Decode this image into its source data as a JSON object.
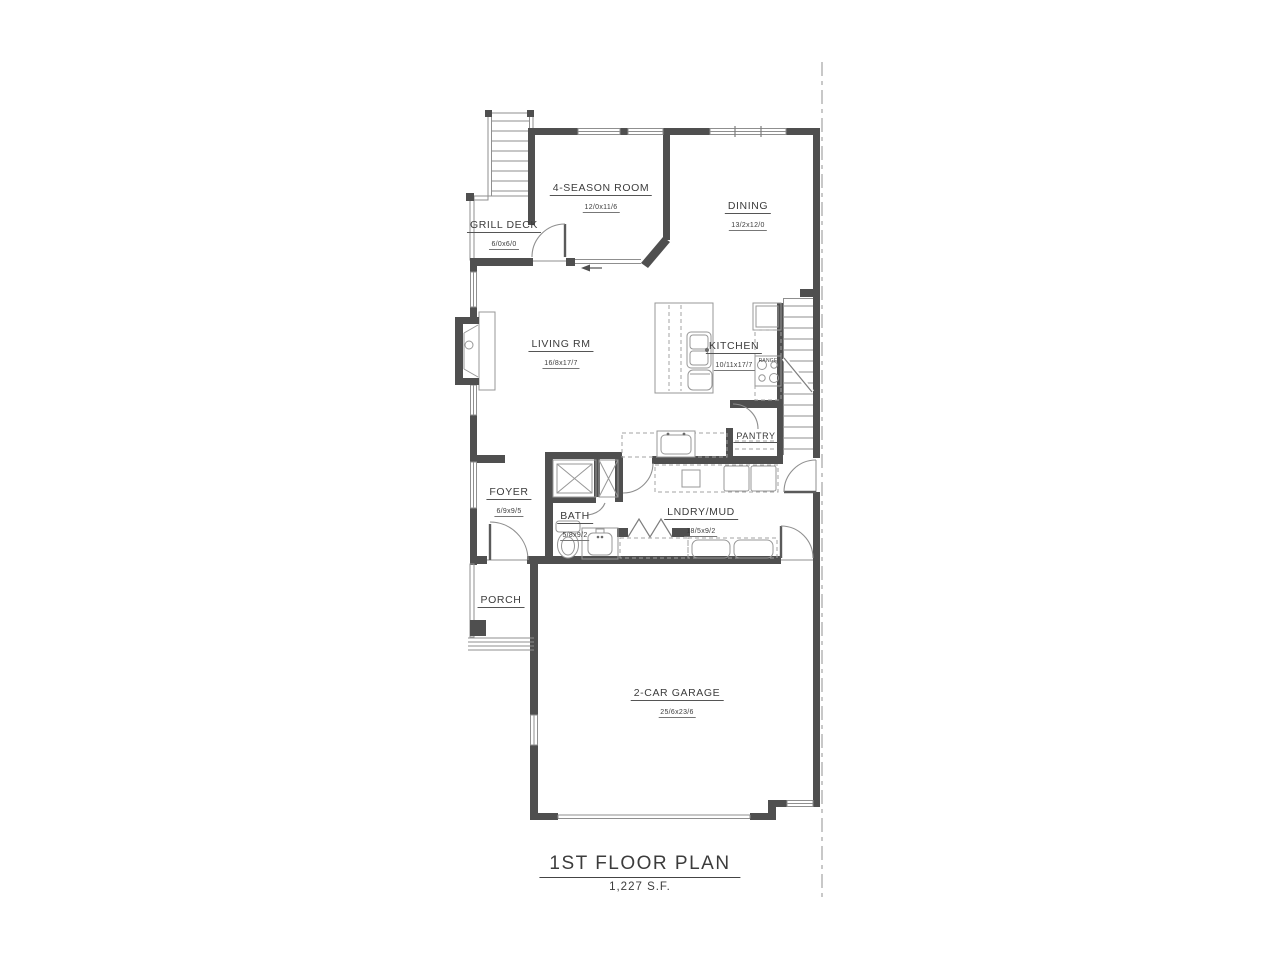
{
  "drawing": {
    "title": "1ST FLOOR PLAN",
    "area": "1,227 S.F."
  },
  "rooms": {
    "grill_deck": {
      "label": "GRILL DECK",
      "dims": "6/0x6/0"
    },
    "season_room": {
      "label": "4-SEASON ROOM",
      "dims": "12/0x11/6"
    },
    "dining": {
      "label": "DINING",
      "dims": "13/2x12/0"
    },
    "living": {
      "label": "LIVING RM",
      "dims": "16/8x17/7"
    },
    "kitchen": {
      "label": "KITCHEN",
      "dims": "10/11x17/7"
    },
    "pantry": {
      "label": "PANTRY"
    },
    "foyer": {
      "label": "FOYER",
      "dims": "6/9x9/5"
    },
    "bath": {
      "label": "BATH",
      "dims": "5/8x9/2"
    },
    "laundry": {
      "label": "LNDRY/MUD",
      "dims": "18/5x9/2"
    },
    "porch": {
      "label": "PORCH"
    },
    "garage": {
      "label": "2-CAR GARAGE",
      "dims": "25/6x23/6"
    }
  },
  "fixtures": {
    "range_label": "RANGE"
  },
  "colors": {
    "wall": "#4f4f4f",
    "thin_line": "#8f8f8f",
    "dashed_fixture": "#a3a3a3",
    "property_line": "#ababab",
    "text": "#3c3c3c",
    "background": "#ffffff"
  }
}
